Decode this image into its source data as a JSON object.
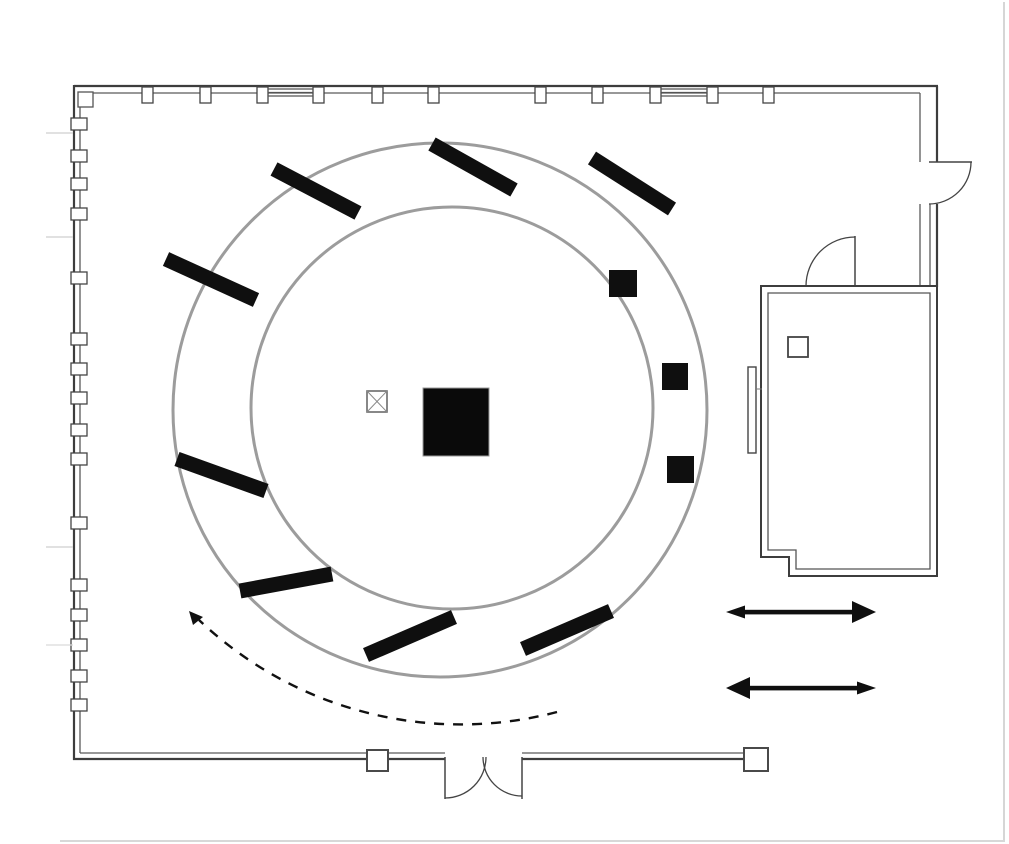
{
  "doc_title": "Floor plan",
  "diagram": {
    "type": "floor-plan",
    "canvas": {
      "width": 1009,
      "height": 844,
      "background": "#ffffff"
    },
    "palette": {
      "wall": "#3d3d3d",
      "wall_light": "#5a5a5a",
      "circle_gray": "#9c9c9c",
      "ink": "#0f0f0f",
      "faint": "#cbcbcb"
    },
    "shapes": [
      {
        "name": "outer-ring-circle",
        "type": "circle",
        "cx": 440,
        "cy": 410,
        "r": 267,
        "stroke": "#9c9c9c",
        "width": 3,
        "fill": "none"
      },
      {
        "name": "inner-ring-circle",
        "type": "circle",
        "cx": 452,
        "cy": 408,
        "r": 201,
        "stroke": "#9c9c9c",
        "width": 3,
        "fill": "none"
      },
      {
        "name": "wall-top-outer",
        "type": "line",
        "x1": 74,
        "y1": 86,
        "x2": 938,
        "y2": 86,
        "stroke": "#3d3d3d",
        "width": 2.2
      },
      {
        "name": "wall-top-inner",
        "type": "line",
        "x1": 80,
        "y1": 93,
        "x2": 920,
        "y2": 93,
        "stroke": "#5a5a5a",
        "width": 1.3
      },
      {
        "name": "wall-left-outer",
        "type": "line",
        "x1": 74,
        "y1": 85,
        "x2": 74,
        "y2": 760,
        "stroke": "#3d3d3d",
        "width": 2.2
      },
      {
        "name": "wall-left-inner",
        "type": "line",
        "x1": 80,
        "y1": 93,
        "x2": 80,
        "y2": 753,
        "stroke": "#5a5a5a",
        "width": 1.3
      },
      {
        "name": "wall-bottom-outer-left",
        "type": "line",
        "x1": 73,
        "y1": 759,
        "x2": 445,
        "y2": 759,
        "stroke": "#3d3d3d",
        "width": 2.2
      },
      {
        "name": "wall-bottom-inner-left",
        "type": "line",
        "x1": 80,
        "y1": 753,
        "x2": 445,
        "y2": 753,
        "stroke": "#5a5a5a",
        "width": 1.3
      },
      {
        "name": "wall-bottom-outer-right",
        "type": "line",
        "x1": 522,
        "y1": 759,
        "x2": 746,
        "y2": 759,
        "stroke": "#3d3d3d",
        "width": 2.2
      },
      {
        "name": "wall-bottom-inner-right",
        "type": "line",
        "x1": 522,
        "y1": 753,
        "x2": 746,
        "y2": 753,
        "stroke": "#5a5a5a",
        "width": 1.3
      },
      {
        "name": "wall-right-outer-upper",
        "type": "line",
        "x1": 937,
        "y1": 86,
        "x2": 937,
        "y2": 162,
        "stroke": "#3d3d3d",
        "width": 2.2
      },
      {
        "name": "wall-right-inner-upper",
        "type": "line",
        "x1": 920,
        "y1": 93,
        "x2": 920,
        "y2": 162,
        "stroke": "#5a5a5a",
        "width": 1.3
      },
      {
        "name": "wall-right-outer-lower",
        "type": "line",
        "x1": 937,
        "y1": 204,
        "x2": 937,
        "y2": 287,
        "stroke": "#3d3d3d",
        "width": 2.2
      },
      {
        "name": "wall-right-inner-lower",
        "type": "line",
        "x1": 920,
        "y1": 204,
        "x2": 920,
        "y2": 287,
        "stroke": "#5a5a5a",
        "width": 1.3
      },
      {
        "name": "wall-right-mid-lower",
        "type": "line",
        "x1": 930,
        "y1": 204,
        "x2": 930,
        "y2": 287,
        "stroke": "#5a5a5a",
        "width": 1.3
      },
      {
        "name": "corner-detail",
        "type": "rect",
        "x": 78,
        "y": 92,
        "w": 15,
        "h": 15,
        "fill": "#ffffff",
        "stroke": "#555555",
        "width": 1.3
      },
      {
        "name": "top-wall-stud-1",
        "type": "rect",
        "x": 142,
        "y": 87,
        "w": 11,
        "h": 16,
        "fill": "#ffffff",
        "stroke": "#444444",
        "width": 1.3
      },
      {
        "name": "top-wall-stud-2",
        "type": "rect",
        "x": 200,
        "y": 87,
        "w": 11,
        "h": 16,
        "fill": "#ffffff",
        "stroke": "#444444",
        "width": 1.3
      },
      {
        "name": "top-wall-stud-3",
        "type": "rect",
        "x": 257,
        "y": 87,
        "w": 11,
        "h": 16,
        "fill": "#ffffff",
        "stroke": "#444444",
        "width": 1.3
      },
      {
        "name": "top-wall-stud-4",
        "type": "rect",
        "x": 313,
        "y": 87,
        "w": 11,
        "h": 16,
        "fill": "#ffffff",
        "stroke": "#444444",
        "width": 1.3
      },
      {
        "name": "top-wall-stud-5",
        "type": "rect",
        "x": 372,
        "y": 87,
        "w": 11,
        "h": 16,
        "fill": "#ffffff",
        "stroke": "#444444",
        "width": 1.3
      },
      {
        "name": "top-wall-stud-6",
        "type": "rect",
        "x": 428,
        "y": 87,
        "w": 11,
        "h": 16,
        "fill": "#ffffff",
        "stroke": "#444444",
        "width": 1.3
      },
      {
        "name": "top-wall-stud-7",
        "type": "rect",
        "x": 535,
        "y": 87,
        "w": 11,
        "h": 16,
        "fill": "#ffffff",
        "stroke": "#444444",
        "width": 1.3
      },
      {
        "name": "top-wall-stud-8",
        "type": "rect",
        "x": 592,
        "y": 87,
        "w": 11,
        "h": 16,
        "fill": "#ffffff",
        "stroke": "#444444",
        "width": 1.3
      },
      {
        "name": "top-wall-stud-9",
        "type": "rect",
        "x": 650,
        "y": 87,
        "w": 11,
        "h": 16,
        "fill": "#ffffff",
        "stroke": "#444444",
        "width": 1.3
      },
      {
        "name": "top-wall-stud-10",
        "type": "rect",
        "x": 707,
        "y": 87,
        "w": 11,
        "h": 16,
        "fill": "#ffffff",
        "stroke": "#444444",
        "width": 1.3
      },
      {
        "name": "top-wall-stud-11",
        "type": "rect",
        "x": 763,
        "y": 87,
        "w": 11,
        "h": 16,
        "fill": "#ffffff",
        "stroke": "#444444",
        "width": 1.3
      },
      {
        "name": "window-strip-1a",
        "type": "line",
        "x1": 268,
        "y1": 89,
        "x2": 313,
        "y2": 89,
        "stroke": "#555555",
        "width": 1.2
      },
      {
        "name": "window-strip-1b",
        "type": "line",
        "x1": 268,
        "y1": 92.5,
        "x2": 313,
        "y2": 92.5,
        "stroke": "#555555",
        "width": 1.2
      },
      {
        "name": "window-strip-1c",
        "type": "line",
        "x1": 268,
        "y1": 96,
        "x2": 313,
        "y2": 96,
        "stroke": "#555555",
        "width": 1.2
      },
      {
        "name": "window-strip-2a",
        "type": "line",
        "x1": 661,
        "y1": 89,
        "x2": 707,
        "y2": 89,
        "stroke": "#555555",
        "width": 1.2
      },
      {
        "name": "window-strip-2b",
        "type": "line",
        "x1": 661,
        "y1": 92.5,
        "x2": 707,
        "y2": 92.5,
        "stroke": "#555555",
        "width": 1.2
      },
      {
        "name": "window-strip-2c",
        "type": "line",
        "x1": 661,
        "y1": 96,
        "x2": 707,
        "y2": 96,
        "stroke": "#555555",
        "width": 1.2
      },
      {
        "name": "left-wall-stud-1",
        "type": "rect",
        "x": 71,
        "y": 118,
        "w": 16,
        "h": 12,
        "fill": "#ffffff",
        "stroke": "#444444",
        "width": 1.3
      },
      {
        "name": "left-wall-stud-2",
        "type": "rect",
        "x": 71,
        "y": 150,
        "w": 16,
        "h": 12,
        "fill": "#ffffff",
        "stroke": "#444444",
        "width": 1.3
      },
      {
        "name": "left-wall-stud-3",
        "type": "rect",
        "x": 71,
        "y": 178,
        "w": 16,
        "h": 12,
        "fill": "#ffffff",
        "stroke": "#444444",
        "width": 1.3
      },
      {
        "name": "left-wall-stud-4",
        "type": "rect",
        "x": 71,
        "y": 208,
        "w": 16,
        "h": 12,
        "fill": "#ffffff",
        "stroke": "#444444",
        "width": 1.3
      },
      {
        "name": "left-wall-stud-5",
        "type": "rect",
        "x": 71,
        "y": 272,
        "w": 16,
        "h": 12,
        "fill": "#ffffff",
        "stroke": "#444444",
        "width": 1.3
      },
      {
        "name": "left-wall-stud-6",
        "type": "rect",
        "x": 71,
        "y": 333,
        "w": 16,
        "h": 12,
        "fill": "#ffffff",
        "stroke": "#444444",
        "width": 1.3
      },
      {
        "name": "left-wall-stud-7",
        "type": "rect",
        "x": 71,
        "y": 363,
        "w": 16,
        "h": 12,
        "fill": "#ffffff",
        "stroke": "#444444",
        "width": 1.3
      },
      {
        "name": "left-wall-stud-8",
        "type": "rect",
        "x": 71,
        "y": 392,
        "w": 16,
        "h": 12,
        "fill": "#ffffff",
        "stroke": "#444444",
        "width": 1.3
      },
      {
        "name": "left-wall-stud-9",
        "type": "rect",
        "x": 71,
        "y": 424,
        "w": 16,
        "h": 12,
        "fill": "#ffffff",
        "stroke": "#444444",
        "width": 1.3
      },
      {
        "name": "left-wall-stud-10",
        "type": "rect",
        "x": 71,
        "y": 453,
        "w": 16,
        "h": 12,
        "fill": "#ffffff",
        "stroke": "#444444",
        "width": 1.3
      },
      {
        "name": "left-wall-stud-11",
        "type": "rect",
        "x": 71,
        "y": 517,
        "w": 16,
        "h": 12,
        "fill": "#ffffff",
        "stroke": "#444444",
        "width": 1.3
      },
      {
        "name": "left-wall-stud-12",
        "type": "rect",
        "x": 71,
        "y": 579,
        "w": 16,
        "h": 12,
        "fill": "#ffffff",
        "stroke": "#444444",
        "width": 1.3
      },
      {
        "name": "left-wall-stud-13",
        "type": "rect",
        "x": 71,
        "y": 609,
        "w": 16,
        "h": 12,
        "fill": "#ffffff",
        "stroke": "#444444",
        "width": 1.3
      },
      {
        "name": "left-wall-stud-14",
        "type": "rect",
        "x": 71,
        "y": 639,
        "w": 16,
        "h": 12,
        "fill": "#ffffff",
        "stroke": "#444444",
        "width": 1.3
      },
      {
        "name": "left-wall-stud-15",
        "type": "rect",
        "x": 71,
        "y": 670,
        "w": 16,
        "h": 12,
        "fill": "#ffffff",
        "stroke": "#444444",
        "width": 1.3
      },
      {
        "name": "left-wall-stud-16",
        "type": "rect",
        "x": 71,
        "y": 699,
        "w": 16,
        "h": 12,
        "fill": "#ffffff",
        "stroke": "#444444",
        "width": 1.3
      },
      {
        "name": "guide-line-1",
        "type": "line",
        "x1": 46,
        "y1": 133,
        "x2": 73,
        "y2": 133,
        "stroke": "#cfcfcf",
        "width": 1.2
      },
      {
        "name": "guide-line-2",
        "type": "line",
        "x1": 46,
        "y1": 237,
        "x2": 73,
        "y2": 237,
        "stroke": "#cfcfcf",
        "width": 1.2
      },
      {
        "name": "guide-line-3",
        "type": "line",
        "x1": 46,
        "y1": 547,
        "x2": 73,
        "y2": 547,
        "stroke": "#cfcfcf",
        "width": 1.2
      },
      {
        "name": "guide-line-4",
        "type": "line",
        "x1": 46,
        "y1": 645,
        "x2": 73,
        "y2": 645,
        "stroke": "#dadada",
        "width": 1.2
      },
      {
        "name": "page-edge-right",
        "type": "line",
        "x1": 1004,
        "y1": 2,
        "x2": 1004,
        "y2": 840,
        "stroke": "#c9c9c9",
        "width": 1.5
      },
      {
        "name": "page-edge-bottom",
        "type": "line",
        "x1": 60,
        "y1": 841,
        "x2": 1005,
        "y2": 841,
        "stroke": "#cccccc",
        "width": 1.5
      },
      {
        "name": "door-right-leaf",
        "type": "line",
        "x1": 929,
        "y1": 162,
        "x2": 972,
        "y2": 162,
        "stroke": "#444444",
        "width": 1.5
      },
      {
        "name": "door-right-swing-arc",
        "type": "path",
        "d": "M 971 162 A 42 42 0 0 1 929 204",
        "stroke": "#444444",
        "width": 1.3,
        "fill": "none"
      },
      {
        "name": "door-sideroom-leaf",
        "type": "line",
        "x1": 855,
        "y1": 236,
        "x2": 855,
        "y2": 286,
        "stroke": "#444444",
        "width": 1.5
      },
      {
        "name": "door-sideroom-swing-arc",
        "type": "path",
        "d": "M 806 286 A 49 49 0 0 1 855 237",
        "stroke": "#444444",
        "width": 1.3,
        "fill": "none"
      },
      {
        "name": "double-door-left-leaf",
        "type": "line",
        "x1": 445,
        "y1": 757,
        "x2": 445,
        "y2": 799,
        "stroke": "#444444",
        "width": 1.5
      },
      {
        "name": "double-door-left-swing-arc",
        "type": "path",
        "d": "M 445 798 A 41 41 0 0 0 486 757",
        "stroke": "#444444",
        "width": 1.3,
        "fill": "none"
      },
      {
        "name": "double-door-right-leaf",
        "type": "line",
        "x1": 522,
        "y1": 757,
        "x2": 522,
        "y2": 799,
        "stroke": "#444444",
        "width": 1.5
      },
      {
        "name": "double-door-right-swing-arc",
        "type": "path",
        "d": "M 522 796 A 39 39 0 0 1 483 757",
        "stroke": "#444444",
        "width": 1.3,
        "fill": "none"
      },
      {
        "name": "circulation-dashed-arc",
        "type": "path",
        "d": "M 557 712 A 380 380 0 0 1 199 620",
        "stroke": "#111111",
        "width": 2.4,
        "fill": "none",
        "dash": "10 9"
      },
      {
        "name": "circulation-arrowhead",
        "type": "polygon",
        "points": "189,611 203,617 193,625",
        "fill": "#111111"
      },
      {
        "name": "radial-panel-1",
        "type": "line",
        "x1": 274,
        "y1": 169,
        "x2": 358,
        "y2": 213,
        "stroke": "#0f0f0f",
        "width": 15
      },
      {
        "name": "radial-panel-2",
        "type": "line",
        "x1": 432,
        "y1": 144,
        "x2": 514,
        "y2": 190,
        "stroke": "#0f0f0f",
        "width": 15
      },
      {
        "name": "radial-panel-3",
        "type": "line",
        "x1": 592,
        "y1": 158,
        "x2": 672,
        "y2": 209,
        "stroke": "#0f0f0f",
        "width": 15
      },
      {
        "name": "radial-panel-4",
        "type": "line",
        "x1": 166,
        "y1": 259,
        "x2": 256,
        "y2": 300,
        "stroke": "#0f0f0f",
        "width": 15
      },
      {
        "name": "radial-panel-5",
        "type": "line",
        "x1": 177,
        "y1": 459,
        "x2": 266,
        "y2": 491,
        "stroke": "#0f0f0f",
        "width": 15
      },
      {
        "name": "radial-panel-6",
        "type": "line",
        "x1": 240,
        "y1": 591,
        "x2": 332,
        "y2": 574,
        "stroke": "#0f0f0f",
        "width": 15
      },
      {
        "name": "radial-panel-7",
        "type": "line",
        "x1": 366,
        "y1": 655,
        "x2": 454,
        "y2": 617,
        "stroke": "#0f0f0f",
        "width": 15
      },
      {
        "name": "radial-panel-8",
        "type": "line",
        "x1": 523,
        "y1": 649,
        "x2": 611,
        "y2": 611,
        "stroke": "#0f0f0f",
        "width": 15
      },
      {
        "name": "ring-pedestal-1",
        "type": "rect",
        "x": 609,
        "y": 270,
        "w": 28,
        "h": 27,
        "fill": "#0f0f0f",
        "stroke": "none",
        "width": 0
      },
      {
        "name": "ring-pedestal-2",
        "type": "rect",
        "x": 662,
        "y": 363,
        "w": 26,
        "h": 27,
        "fill": "#0f0f0f",
        "stroke": "none",
        "width": 0
      },
      {
        "name": "ring-pedestal-3",
        "type": "rect",
        "x": 667,
        "y": 456,
        "w": 27,
        "h": 27,
        "fill": "#0f0f0f",
        "stroke": "none",
        "width": 0
      },
      {
        "name": "central-plinth",
        "type": "rect",
        "x": 423,
        "y": 388,
        "w": 66,
        "h": 68,
        "fill": "#0a0a0a",
        "stroke": "#999999",
        "width": 1
      },
      {
        "name": "column-marker-box",
        "type": "rect",
        "x": 367,
        "y": 391,
        "w": 20,
        "h": 21,
        "fill": "#ffffff",
        "stroke": "#6a6a6a",
        "width": 1.6
      },
      {
        "name": "column-marker-diag-1",
        "type": "line",
        "x1": 367,
        "y1": 391,
        "x2": 387,
        "y2": 412,
        "stroke": "#8a8a8a",
        "width": 1
      },
      {
        "name": "column-marker-diag-2",
        "type": "line",
        "x1": 387,
        "y1": 391,
        "x2": 367,
        "y2": 412,
        "stroke": "#8a8a8a",
        "width": 1
      },
      {
        "name": "side-room-outer-wall",
        "type": "path",
        "d": "M 761 286 L 937 286 L 937 576 L 789 576 L 789 557 L 761 557 Z",
        "stroke": "#3d3d3d",
        "width": 2,
        "fill": "#ffffff"
      },
      {
        "name": "side-room-inner-wall",
        "type": "path",
        "d": "M 768 293 L 930 293 L 930 569 L 796 569 L 796 550 L 768 550 Z",
        "stroke": "#555555",
        "width": 1.3,
        "fill": "none"
      },
      {
        "name": "side-room-square",
        "type": "rect",
        "x": 788,
        "y": 337,
        "w": 20,
        "h": 20,
        "fill": "#ffffff",
        "stroke": "#444444",
        "width": 1.8
      },
      {
        "name": "side-room-panel",
        "type": "rect",
        "x": 748,
        "y": 367,
        "w": 8,
        "h": 86,
        "fill": "#ffffff",
        "stroke": "#444444",
        "width": 1.4
      },
      {
        "name": "side-room-panel-tick",
        "type": "line",
        "x1": 756,
        "y1": 389,
        "x2": 762,
        "y2": 389,
        "stroke": "#777777",
        "width": 1
      },
      {
        "name": "wall-post-square-1",
        "type": "rect",
        "x": 367,
        "y": 750,
        "w": 21,
        "h": 21,
        "fill": "#ffffff",
        "stroke": "#4a4a4a",
        "width": 2
      },
      {
        "name": "wall-post-square-2",
        "type": "rect",
        "x": 744,
        "y": 748,
        "w": 24,
        "h": 23,
        "fill": "#ffffff",
        "stroke": "#4a4a4a",
        "width": 2
      },
      {
        "name": "movement-arrow-1-shaft",
        "type": "rect",
        "x": 743,
        "y": 609.8,
        "w": 111,
        "h": 4.6,
        "fill": "#0f0f0f",
        "stroke": "none",
        "width": 0
      },
      {
        "name": "movement-arrow-1-head-left",
        "type": "polygon",
        "points": "726,612 745,605.5 745,618.5",
        "fill": "#0f0f0f"
      },
      {
        "name": "movement-arrow-1-head-right",
        "type": "polygon",
        "points": "876,612 852,601 852,623",
        "fill": "#0f0f0f"
      },
      {
        "name": "movement-arrow-2-shaft",
        "type": "rect",
        "x": 747,
        "y": 685.8,
        "w": 111,
        "h": 4.6,
        "fill": "#0f0f0f",
        "stroke": "none",
        "width": 0
      },
      {
        "name": "movement-arrow-2-head-left",
        "type": "polygon",
        "points": "726,688 750,677 750,699",
        "fill": "#0f0f0f"
      },
      {
        "name": "movement-arrow-2-head-right",
        "type": "polygon",
        "points": "876,688 857,681.5 857,694.5",
        "fill": "#0f0f0f"
      }
    ]
  }
}
